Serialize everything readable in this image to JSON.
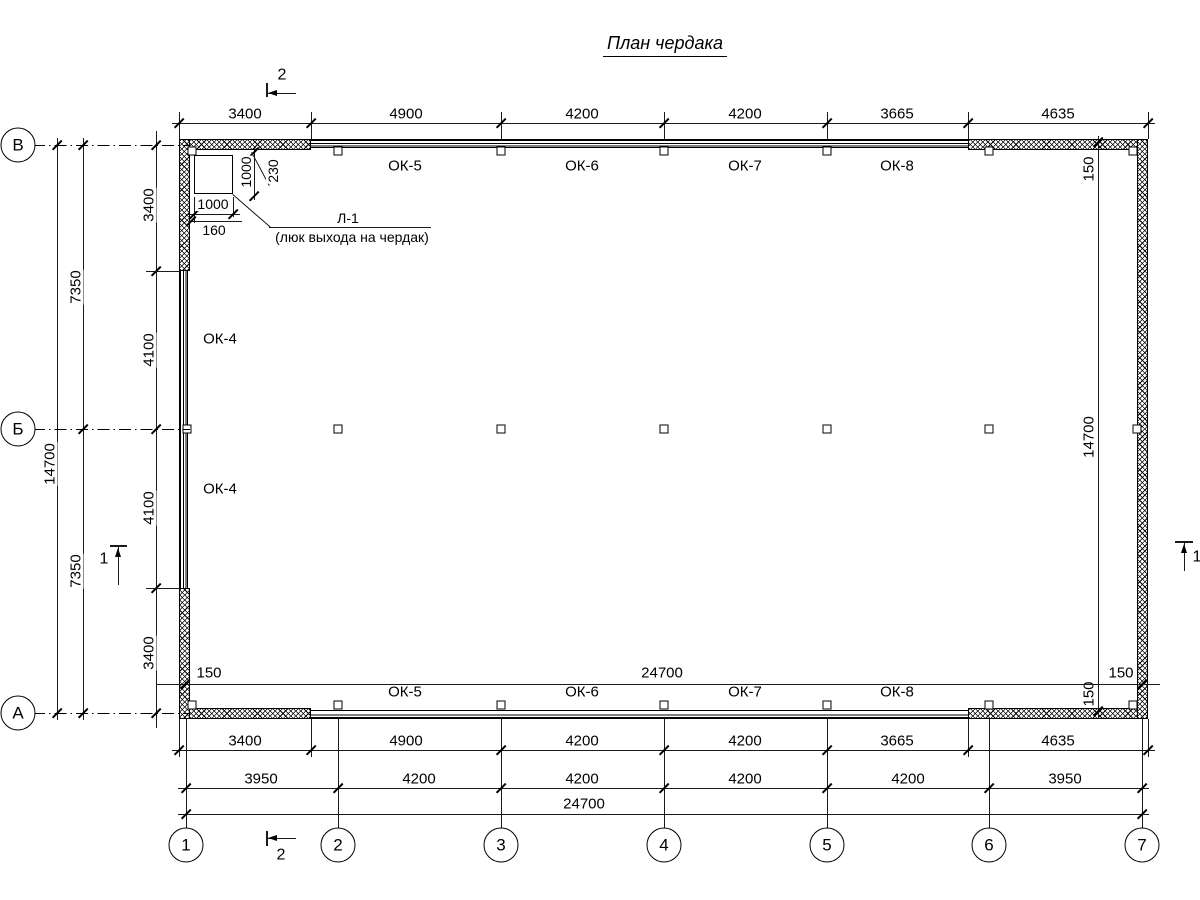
{
  "title": "План чердака",
  "colors": {
    "line": "#000000",
    "background": "#ffffff"
  },
  "axes": {
    "rows": [
      "В",
      "Б",
      "А"
    ],
    "cols": [
      "1",
      "2",
      "3",
      "4",
      "5",
      "6",
      "7"
    ]
  },
  "dims": {
    "top": [
      "3400",
      "4900",
      "4200",
      "4200",
      "3665",
      "4635"
    ],
    "bottom_row1": [
      "3400",
      "4900",
      "4200",
      "4200",
      "3665",
      "4635"
    ],
    "bottom_row2": [
      "3950",
      "4200",
      "4200",
      "4200",
      "4200",
      "3950"
    ],
    "bottom_total": "24700",
    "interior_width": "24700",
    "left_inner": [
      "3400",
      "4100",
      "4100",
      "3400"
    ],
    "left_mid": [
      "7350",
      "7350"
    ],
    "left_total": "14700",
    "right_total": "14700",
    "offset": "150"
  },
  "windows": {
    "top": [
      "ОК-5",
      "ОК-6",
      "ОК-7",
      "ОК-8"
    ],
    "bottom": [
      "ОК-5",
      "ОК-6",
      "ОК-7",
      "ОК-8"
    ],
    "left": [
      "ОК-4",
      "ОК-4"
    ]
  },
  "hatch_door": {
    "label": "Л-1",
    "sublabel": "(люк выхода на чердак)",
    "dims": {
      "height": "1000",
      "offset_wall": "230",
      "width": "1000",
      "offset_side": "160"
    }
  },
  "sections": {
    "s1": "1",
    "s2": "2"
  }
}
